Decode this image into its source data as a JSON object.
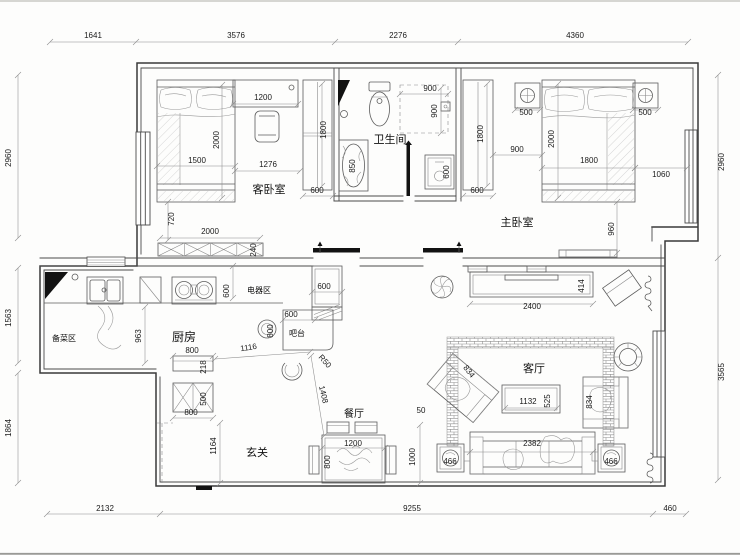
{
  "canvas": {
    "width": 740,
    "height": 555,
    "background": "#fdfdfc",
    "wall_color": "#3a3a3a",
    "dim_line_color": "#8c8c8c",
    "text_color": "#1a1a1a"
  },
  "room_labels": [
    {
      "t": "客卧室",
      "x": 269,
      "y": 193,
      "s": 11
    },
    {
      "t": "卫生间",
      "x": 390,
      "y": 143,
      "s": 11
    },
    {
      "t": "主卧室",
      "x": 517,
      "y": 226,
      "s": 11
    },
    {
      "t": "厨房",
      "x": 184,
      "y": 341,
      "s": 12
    },
    {
      "t": "备菜区",
      "x": 64,
      "y": 341,
      "s": 8
    },
    {
      "t": "电器区",
      "x": 259,
      "y": 293,
      "s": 8
    },
    {
      "t": "吧台",
      "x": 297,
      "y": 336,
      "s": 8
    },
    {
      "t": "玄关",
      "x": 257,
      "y": 456,
      "s": 11
    },
    {
      "t": "餐厅",
      "x": 354,
      "y": 417,
      "s": 10
    },
    {
      "t": "客厅",
      "x": 534,
      "y": 372,
      "s": 11
    }
  ],
  "dim_labels": [
    {
      "t": "1641",
      "x": 93,
      "y": 38
    },
    {
      "t": "3576",
      "x": 236,
      "y": 38
    },
    {
      "t": "2276",
      "x": 398,
      "y": 38
    },
    {
      "t": "4360",
      "x": 575,
      "y": 38
    },
    {
      "t": "2960",
      "x": 11,
      "y": 158,
      "r": -90
    },
    {
      "t": "1563",
      "x": 11,
      "y": 318,
      "r": -90
    },
    {
      "t": "1864",
      "x": 11,
      "y": 428,
      "r": -90
    },
    {
      "t": "2960",
      "x": 724,
      "y": 162,
      "r": -90
    },
    {
      "t": "3565",
      "x": 724,
      "y": 372,
      "r": -90
    },
    {
      "t": "2132",
      "x": 105,
      "y": 511
    },
    {
      "t": "9255",
      "x": 412,
      "y": 511
    },
    {
      "t": "460",
      "x": 670,
      "y": 511
    },
    {
      "t": "1500",
      "x": 197,
      "y": 163
    },
    {
      "t": "2000",
      "x": 219,
      "y": 140,
      "r": -90
    },
    {
      "t": "1200",
      "x": 263,
      "y": 100
    },
    {
      "t": "1276",
      "x": 268,
      "y": 167
    },
    {
      "t": "1800",
      "x": 326,
      "y": 130,
      "r": -90
    },
    {
      "t": "600",
      "x": 317,
      "y": 193
    },
    {
      "t": "720",
      "x": 174,
      "y": 219,
      "r": -90
    },
    {
      "t": "2000",
      "x": 210,
      "y": 234
    },
    {
      "t": "240",
      "x": 256,
      "y": 250,
      "r": -90
    },
    {
      "t": "850",
      "x": 355,
      "y": 166,
      "r": -90
    },
    {
      "t": "900",
      "x": 430,
      "y": 91
    },
    {
      "t": "900",
      "x": 437,
      "y": 111,
      "r": -90
    },
    {
      "t": "600",
      "x": 449,
      "y": 172,
      "r": -90
    },
    {
      "t": "1800",
      "x": 483,
      "y": 134,
      "r": -90
    },
    {
      "t": "600",
      "x": 477,
      "y": 193
    },
    {
      "t": "900",
      "x": 517,
      "y": 152
    },
    {
      "t": "500",
      "x": 526,
      "y": 115
    },
    {
      "t": "500",
      "x": 645,
      "y": 115
    },
    {
      "t": "2000",
      "x": 554,
      "y": 139,
      "r": -90
    },
    {
      "t": "1800",
      "x": 589,
      "y": 163
    },
    {
      "t": "1060",
      "x": 661,
      "y": 177
    },
    {
      "t": "960",
      "x": 614,
      "y": 229,
      "r": -90
    },
    {
      "t": "600",
      "x": 229,
      "y": 291,
      "r": -90
    },
    {
      "t": "600",
      "x": 324,
      "y": 289
    },
    {
      "t": "600",
      "x": 291,
      "y": 317
    },
    {
      "t": "800",
      "x": 273,
      "y": 331,
      "r": -90
    },
    {
      "t": "963",
      "x": 141,
      "y": 336,
      "r": -90
    },
    {
      "t": "800",
      "x": 192,
      "y": 353
    },
    {
      "t": "218",
      "x": 206,
      "y": 367,
      "r": -90
    },
    {
      "t": "500",
      "x": 206,
      "y": 399,
      "r": -90
    },
    {
      "t": "800",
      "x": 191,
      "y": 415
    },
    {
      "t": "1164",
      "x": 216,
      "y": 446,
      "r": -90
    },
    {
      "t": "1116",
      "x": 249,
      "y": 350,
      "r": -9
    },
    {
      "t": "R50",
      "x": 323,
      "y": 363,
      "r": 48
    },
    {
      "t": "1408",
      "x": 321,
      "y": 395,
      "r": 77
    },
    {
      "t": "2400",
      "x": 532,
      "y": 309
    },
    {
      "t": "414",
      "x": 584,
      "y": 286,
      "r": -90
    },
    {
      "t": "1132",
      "x": 528,
      "y": 404
    },
    {
      "t": "525",
      "x": 550,
      "y": 401,
      "r": -90
    },
    {
      "t": "834",
      "x": 467,
      "y": 373,
      "r": 52
    },
    {
      "t": "834",
      "x": 592,
      "y": 402,
      "r": -90
    },
    {
      "t": "2382",
      "x": 532,
      "y": 446
    },
    {
      "t": "466",
      "x": 450,
      "y": 464
    },
    {
      "t": "466",
      "x": 611,
      "y": 464
    },
    {
      "t": "1200",
      "x": 353,
      "y": 446
    },
    {
      "t": "800",
      "x": 330,
      "y": 462,
      "r": -90
    },
    {
      "t": "50",
      "x": 421,
      "y": 413
    },
    {
      "t": "1000",
      "x": 415,
      "y": 457,
      "r": -90
    }
  ]
}
